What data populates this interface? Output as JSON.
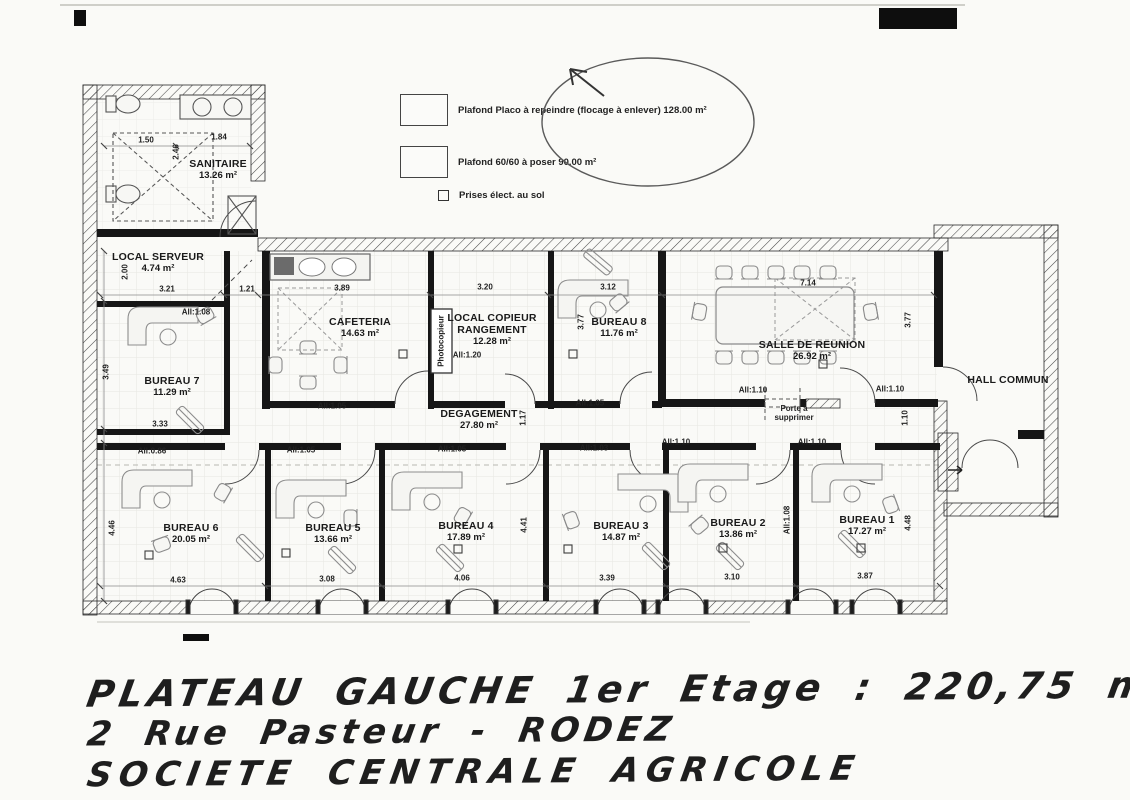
{
  "legend": {
    "items": [
      {
        "id": "plafond-placo",
        "swatch": "plain",
        "label": "Plafond Placo à repeindre (flocage à enlever) 128.00 m²"
      },
      {
        "id": "plafond-6060",
        "swatch": "grid",
        "label": "Plafond 60/60 à poser 90.00 m²"
      },
      {
        "id": "prises-elect",
        "swatch": "outlet-square",
        "label": "Prises élect. au sol"
      }
    ]
  },
  "title_block": {
    "line1": "PLATEAU GAUCHE 1er Etage : 220,75 m²",
    "line2": "2 Rue Pasteur - RODEZ",
    "line3": "SOCIETE CENTRALE AGRICOLE"
  },
  "plan": {
    "rooms": [
      {
        "id": "sanitaire",
        "name": "SANITAIRE",
        "area": "13.26 m²",
        "x": 218,
        "y": 170
      },
      {
        "id": "local-serveur",
        "name": "LOCAL SERVEUR",
        "area": "4.74 m²",
        "x": 158,
        "y": 263
      },
      {
        "id": "bureau-7",
        "name": "BUREAU 7",
        "area": "11.29 m²",
        "x": 172,
        "y": 387
      },
      {
        "id": "cafeteria",
        "name": "CAFETERIA",
        "area": "14.63 m²",
        "x": 360,
        "y": 328
      },
      {
        "id": "local-copieur",
        "name": "LOCAL COPIEUR",
        "name2": "RANGEMENT",
        "area": "12.28 m²",
        "x": 492,
        "y": 330
      },
      {
        "id": "bureau-8",
        "name": "BUREAU 8",
        "area": "11.76 m²",
        "x": 619,
        "y": 328
      },
      {
        "id": "salle-de-reunion",
        "name": "SALLE DE REUNION",
        "area": "26.92 m²",
        "x": 812,
        "y": 351
      },
      {
        "id": "hall-commun",
        "name": "HALL COMMUN",
        "area": "",
        "x": 1008,
        "y": 381
      },
      {
        "id": "degagement",
        "name": "DEGAGEMENT",
        "area": "27.80 m²",
        "x": 479,
        "y": 420
      },
      {
        "id": "bureau-6",
        "name": "BUREAU 6",
        "area": "20.05 m²",
        "x": 191,
        "y": 534
      },
      {
        "id": "bureau-5",
        "name": "BUREAU 5",
        "area": "13.66 m²",
        "x": 333,
        "y": 534
      },
      {
        "id": "bureau-4",
        "name": "BUREAU 4",
        "area": "17.89 m²",
        "x": 466,
        "y": 532
      },
      {
        "id": "bureau-3",
        "name": "BUREAU 3",
        "area": "14.87 m²",
        "x": 621,
        "y": 532
      },
      {
        "id": "bureau-2",
        "name": "BUREAU 2",
        "area": "13.86 m²",
        "x": 738,
        "y": 529
      },
      {
        "id": "bureau-1",
        "name": "BUREAU 1",
        "area": "17.27 m²",
        "x": 867,
        "y": 526
      }
    ],
    "annotations": [
      {
        "id": "photocopieur",
        "lines": [
          "Photocopieur"
        ],
        "x": 441,
        "y": 341,
        "rot": true
      },
      {
        "id": "porte-a-supprimer",
        "lines": [
          "Porte à",
          "supprimer"
        ],
        "x": 794,
        "y": 413
      }
    ],
    "dimensions": [
      {
        "v": "1.50",
        "x": 146,
        "y": 140
      },
      {
        "v": "1.84",
        "x": 219,
        "y": 137
      },
      {
        "v": "2.46",
        "x": 176,
        "y": 152,
        "rot": true
      },
      {
        "v": "2.00",
        "x": 125,
        "y": 272,
        "rot": true
      },
      {
        "v": "3.21",
        "x": 167,
        "y": 289
      },
      {
        "v": "1.21",
        "x": 247,
        "y": 289
      },
      {
        "v": "3.89",
        "x": 342,
        "y": 288
      },
      {
        "v": "3.20",
        "x": 485,
        "y": 287
      },
      {
        "v": "3.12",
        "x": 608,
        "y": 287
      },
      {
        "v": "7.14",
        "x": 808,
        "y": 283
      },
      {
        "v": "3.77",
        "x": 581,
        "y": 322,
        "rot": true
      },
      {
        "v": "3.77",
        "x": 908,
        "y": 320,
        "rot": true
      },
      {
        "v": "3.49",
        "x": 106,
        "y": 372,
        "rot": true
      },
      {
        "v": "3.33",
        "x": 160,
        "y": 424
      },
      {
        "v": "1.17",
        "x": 523,
        "y": 418,
        "rot": true
      },
      {
        "v": "1.10",
        "x": 905,
        "y": 418,
        "rot": true
      },
      {
        "v": "4.46",
        "x": 112,
        "y": 528,
        "rot": true
      },
      {
        "v": "4.41",
        "x": 524,
        "y": 525,
        "rot": true
      },
      {
        "v": "4.48",
        "x": 908,
        "y": 523,
        "rot": true
      },
      {
        "v": "All:1.08",
        "x": 787,
        "y": 520,
        "rot": true
      },
      {
        "v": "4.63",
        "x": 178,
        "y": 580
      },
      {
        "v": "3.08",
        "x": 327,
        "y": 579
      },
      {
        "v": "4.06",
        "x": 462,
        "y": 578
      },
      {
        "v": "3.39",
        "x": 607,
        "y": 578
      },
      {
        "v": "3.10",
        "x": 732,
        "y": 577
      },
      {
        "v": "3.87",
        "x": 865,
        "y": 576
      },
      {
        "v": "All:1.08",
        "x": 196,
        "y": 312
      },
      {
        "v": "All:1.05",
        "x": 332,
        "y": 406
      },
      {
        "v": "All:1.20",
        "x": 467,
        "y": 355
      },
      {
        "v": "All:1.05",
        "x": 590,
        "y": 403
      },
      {
        "v": "All:1.10",
        "x": 753,
        "y": 390
      },
      {
        "v": "All:1.10",
        "x": 890,
        "y": 389
      },
      {
        "v": "All:1.10",
        "x": 676,
        "y": 442
      },
      {
        "v": "All:1.10",
        "x": 812,
        "y": 442
      },
      {
        "v": "All:0.86",
        "x": 152,
        "y": 451
      },
      {
        "v": "All:1.05",
        "x": 301,
        "y": 450
      },
      {
        "v": "All:1.05",
        "x": 452,
        "y": 449
      },
      {
        "v": "All:1.03",
        "x": 594,
        "y": 448
      }
    ]
  }
}
